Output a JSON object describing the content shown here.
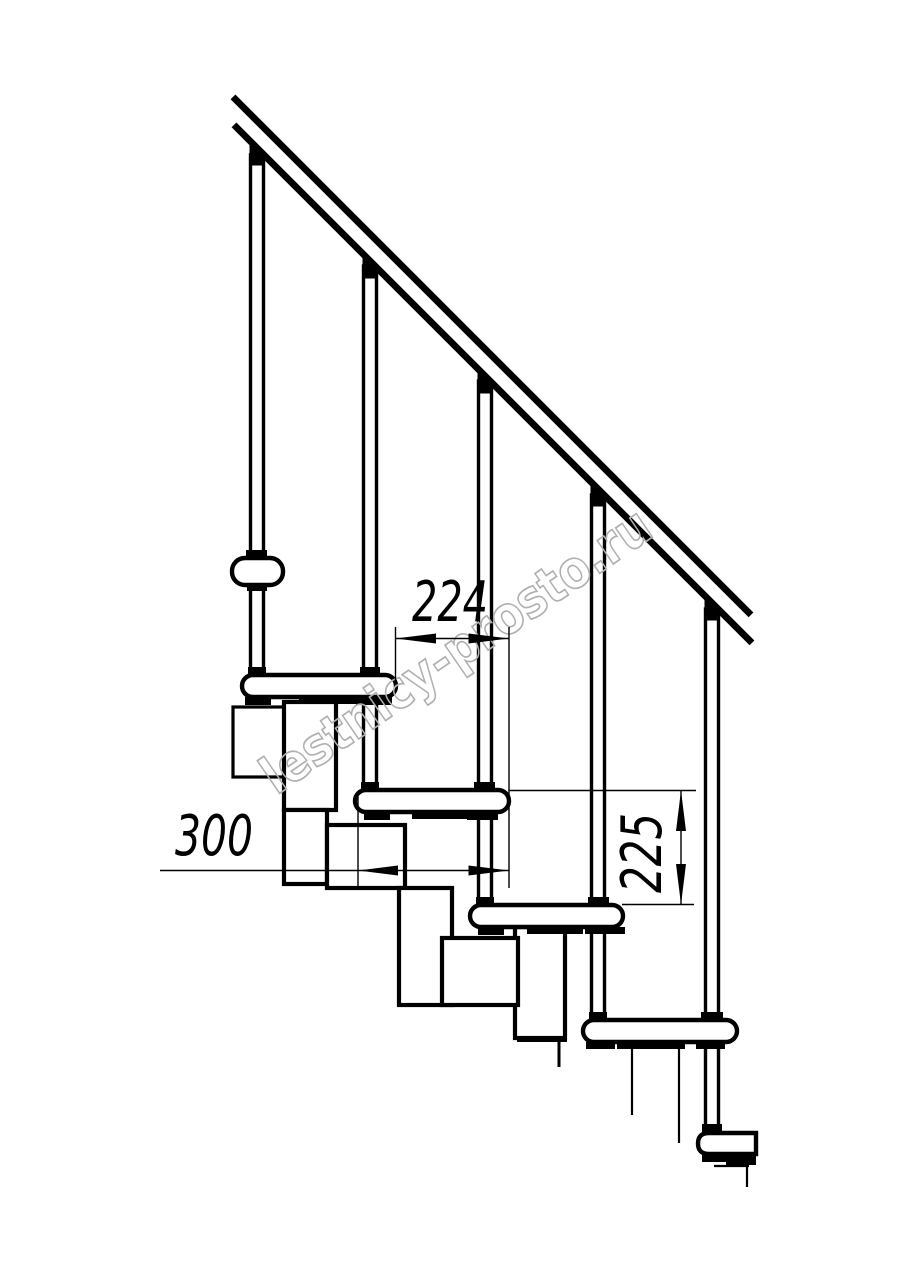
{
  "page": {
    "background_color": "#ffffff",
    "line_color": "#000000"
  },
  "drawing": {
    "kind": "staircase side elevation, modular stairs with handrail",
    "dimensions": {
      "step_run": {
        "label": "224"
      },
      "tread_depth": {
        "label": "300"
      },
      "step_rise": {
        "label": "225"
      }
    },
    "watermark": {
      "text": "lestnicy-prosto.ru",
      "color": "#b0b0b0"
    }
  }
}
